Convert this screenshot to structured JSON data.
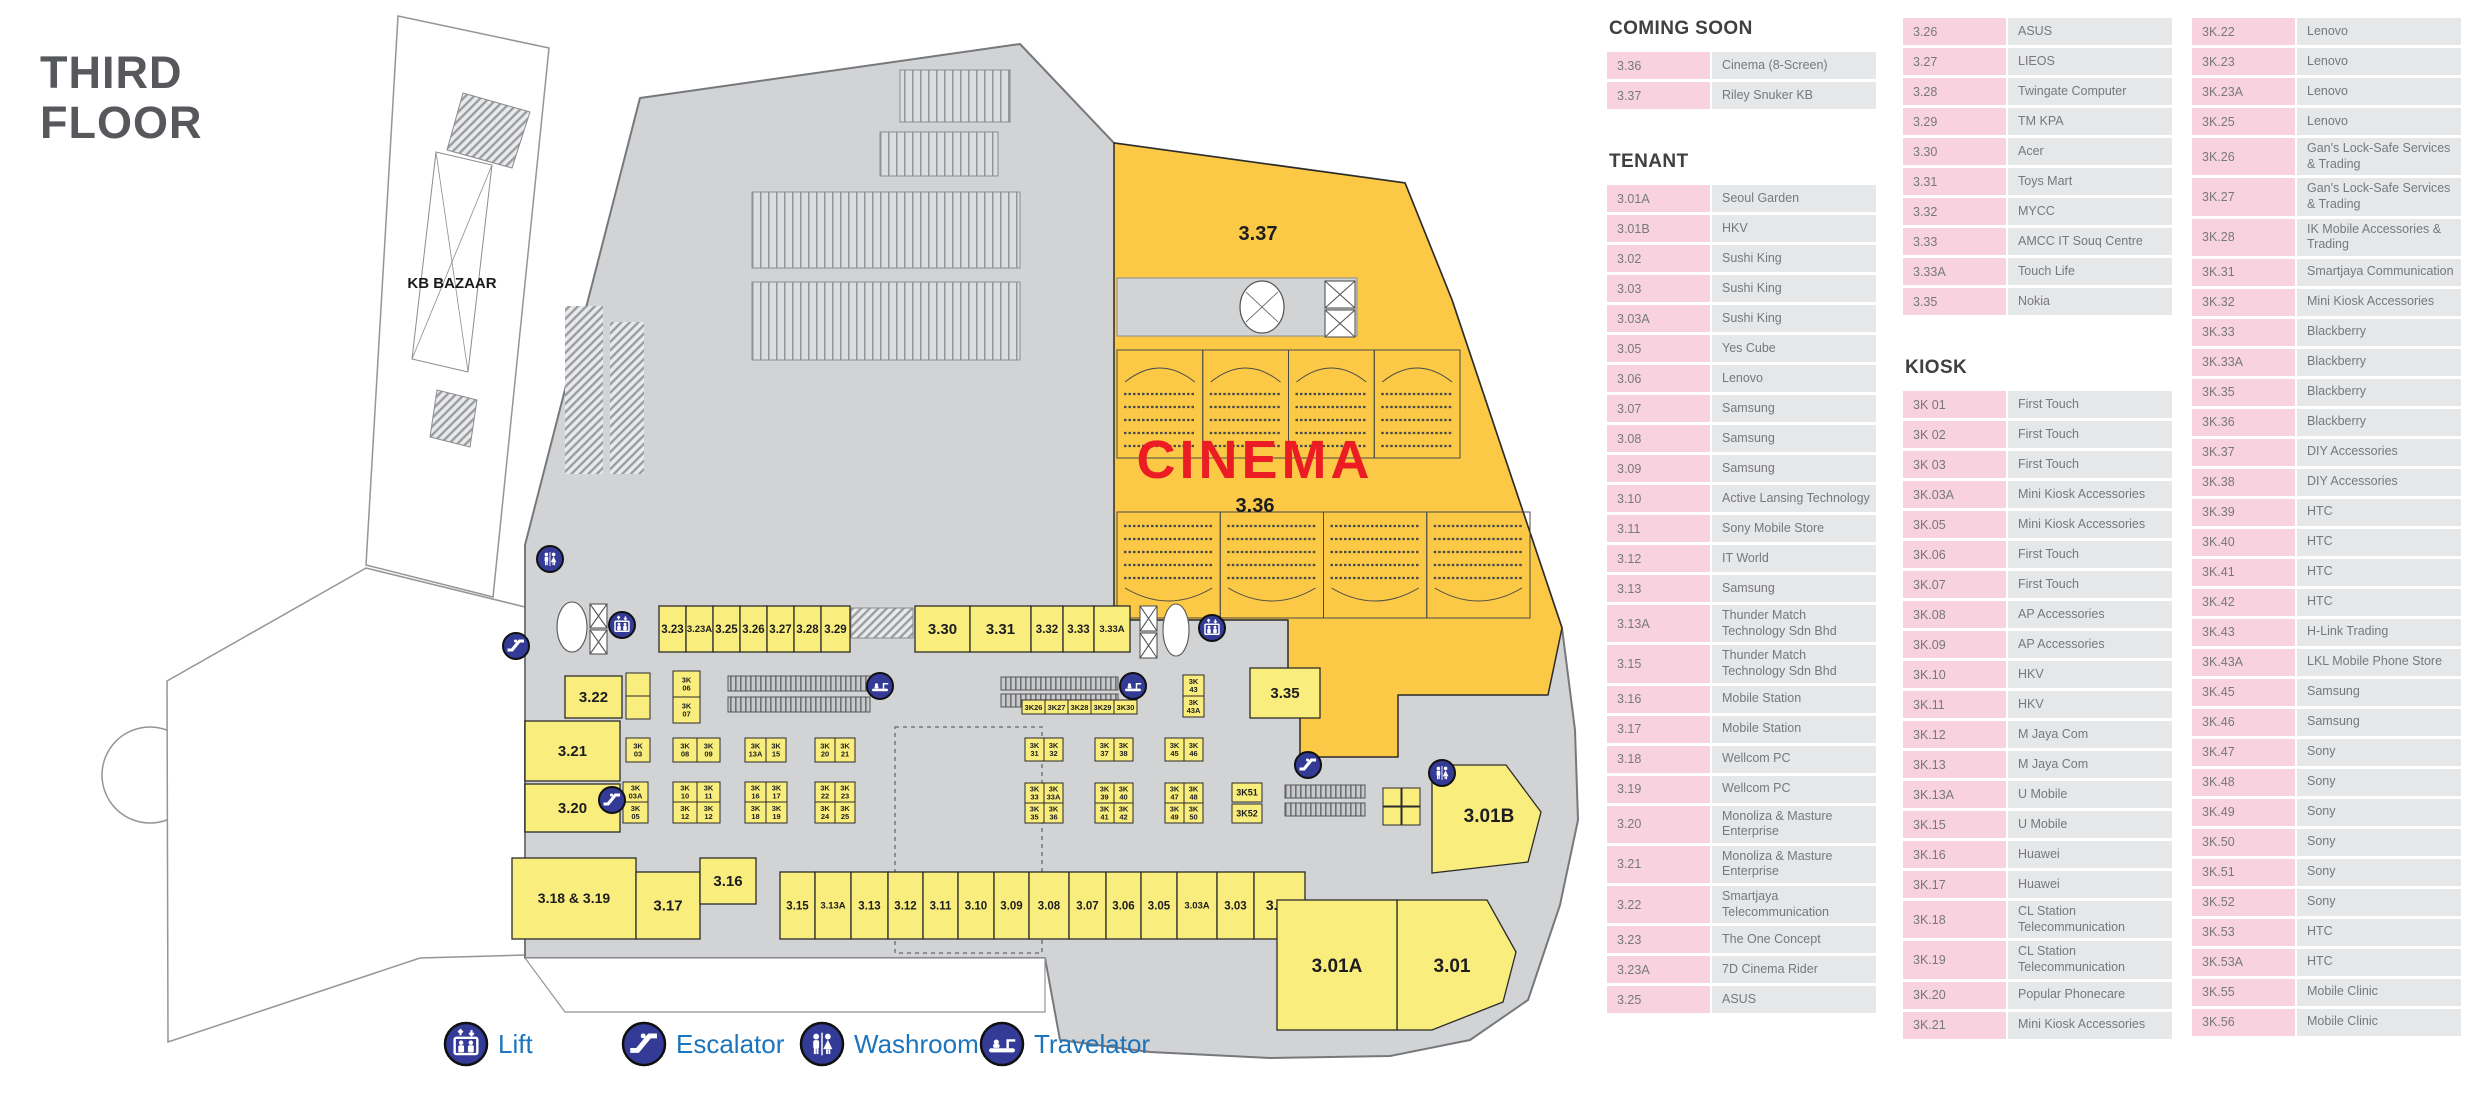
{
  "title": {
    "line1": "THIRD",
    "line2": "FLOOR"
  },
  "colors": {
    "plan_gray": "#d2d3d5",
    "unit_yellow": "#f9ee7d",
    "cinema_amber": "#fbc945",
    "cinema_red": "#ec1c24",
    "icon_blue": "#343b97",
    "legend_text_blue": "#1c75bc",
    "dir_pink": "#f8d3df",
    "dir_gray": "#e6e7e8",
    "title_gray": "#57585b"
  },
  "legend": [
    {
      "icon": "lift-icon",
      "type": "lift",
      "label": "Lift",
      "cx": 466
    },
    {
      "icon": "escalator-icon",
      "type": "escalator",
      "label": "Escalator",
      "cx": 644
    },
    {
      "icon": "washroom-icon",
      "type": "washroom",
      "label": "Washroom",
      "cx": 822
    },
    {
      "icon": "travelator-icon",
      "type": "travelator",
      "label": "Travelator",
      "cx": 1002
    }
  ],
  "plan": {
    "labels": [
      {
        "t": "KB BAZAAR",
        "x": 452,
        "y": 288,
        "fs": 15,
        "c": "#1a1a1a"
      },
      {
        "t": "3.37",
        "x": 1258,
        "y": 240,
        "fs": 20,
        "c": "#1d1d1f"
      },
      {
        "t": "CINEMA",
        "x": 1255,
        "y": 478,
        "fs": 54,
        "c": "#ec1c24",
        "ls": 4
      },
      {
        "t": "3.36",
        "x": 1255,
        "y": 512,
        "fs": 20,
        "c": "#1d1d1f"
      },
      {
        "t": "3.01B",
        "x": 1489,
        "y": 822,
        "fs": 19,
        "c": "#1d1d1f"
      },
      {
        "t": "3.01A",
        "x": 1337,
        "y": 972,
        "fs": 19,
        "c": "#1d1d1f"
      },
      {
        "t": "3.01",
        "x": 1452,
        "y": 972,
        "fs": 19,
        "c": "#1d1d1f"
      }
    ],
    "shops": [
      {
        "l": "3.23",
        "x": 659,
        "y": 606,
        "w": 27,
        "h": 46
      },
      {
        "l": "3.23A",
        "x": 686,
        "y": 606,
        "w": 27,
        "h": 46
      },
      {
        "l": "3.25",
        "x": 713,
        "y": 606,
        "w": 27,
        "h": 46
      },
      {
        "l": "3.26",
        "x": 740,
        "y": 606,
        "w": 27,
        "h": 46
      },
      {
        "l": "3.27",
        "x": 767,
        "y": 606,
        "w": 27,
        "h": 46
      },
      {
        "l": "3.28",
        "x": 794,
        "y": 606,
        "w": 27,
        "h": 46
      },
      {
        "l": "3.29",
        "x": 821,
        "y": 606,
        "w": 29,
        "h": 46
      },
      {
        "l": "3.30",
        "x": 915,
        "y": 606,
        "w": 55,
        "h": 46
      },
      {
        "l": "3.31",
        "x": 970,
        "y": 606,
        "w": 61,
        "h": 46
      },
      {
        "l": "3.32",
        "x": 1031,
        "y": 606,
        "w": 32,
        "h": 46
      },
      {
        "l": "3.33",
        "x": 1063,
        "y": 606,
        "w": 31,
        "h": 46
      },
      {
        "l": "3.33A",
        "x": 1094,
        "y": 606,
        "w": 36,
        "h": 46
      },
      {
        "l": "3.35",
        "x": 1250,
        "y": 668,
        "w": 70,
        "h": 50
      },
      {
        "l": "3.22",
        "x": 565,
        "y": 676,
        "w": 57,
        "h": 42
      },
      {
        "l": "3.21",
        "x": 525,
        "y": 721,
        "w": 95,
        "h": 60
      },
      {
        "l": "3.20",
        "x": 525,
        "y": 784,
        "w": 95,
        "h": 48
      },
      {
        "l": "3.18 & 3.19",
        "x": 512,
        "y": 858,
        "w": 124,
        "h": 81,
        "fs": 14
      },
      {
        "l": "3.17",
        "x": 636,
        "y": 872,
        "w": 64,
        "h": 67
      },
      {
        "l": "3.16",
        "x": 700,
        "y": 858,
        "w": 56,
        "h": 46
      },
      {
        "l": "3.15",
        "x": 780,
        "y": 872,
        "w": 35,
        "h": 67
      },
      {
        "l": "3.13A",
        "x": 815,
        "y": 872,
        "w": 36,
        "h": 67
      },
      {
        "l": "3.13",
        "x": 851,
        "y": 872,
        "w": 37,
        "h": 67
      },
      {
        "l": "3.12",
        "x": 888,
        "y": 872,
        "w": 35,
        "h": 67
      },
      {
        "l": "3.11",
        "x": 923,
        "y": 872,
        "w": 35,
        "h": 67
      },
      {
        "l": "3.10",
        "x": 958,
        "y": 872,
        "w": 36,
        "h": 67
      },
      {
        "l": "3.09",
        "x": 994,
        "y": 872,
        "w": 35,
        "h": 67
      },
      {
        "l": "3.08",
        "x": 1029,
        "y": 872,
        "w": 40,
        "h": 67
      },
      {
        "l": "3.07",
        "x": 1069,
        "y": 872,
        "w": 37,
        "h": 67
      },
      {
        "l": "3.06",
        "x": 1106,
        "y": 872,
        "w": 35,
        "h": 67
      },
      {
        "l": "3.05",
        "x": 1141,
        "y": 872,
        "w": 36,
        "h": 67
      },
      {
        "l": "3.03A",
        "x": 1177,
        "y": 872,
        "w": 40,
        "h": 67
      },
      {
        "l": "3.03",
        "x": 1217,
        "y": 872,
        "w": 37,
        "h": 67
      },
      {
        "l": "3.02",
        "x": 1254,
        "y": 872,
        "w": 51,
        "h": 67
      },
      {
        "l": "3.01A",
        "x": 1277,
        "y": 900,
        "w": 120,
        "h": 130,
        "fs": 0
      }
    ],
    "kiosks": [
      {
        "l": "",
        "x": 626,
        "y": 673,
        "w": 24,
        "h": 23
      },
      {
        "l": "",
        "x": 626,
        "y": 696,
        "w": 24,
        "h": 23
      },
      {
        "l": "3K 06",
        "x": 673,
        "y": 671,
        "w": 27,
        "h": 26
      },
      {
        "l": "3K 07",
        "x": 673,
        "y": 697,
        "w": 27,
        "h": 26
      },
      {
        "l": "3K 03",
        "x": 626,
        "y": 738,
        "w": 24,
        "h": 24
      },
      {
        "l": "3K 08",
        "x": 673,
        "y": 738,
        "w": 24,
        "h": 24
      },
      {
        "l": "3K 09",
        "x": 697,
        "y": 738,
        "w": 23,
        "h": 24
      },
      {
        "l": "3K 13A",
        "x": 745,
        "y": 738,
        "w": 21,
        "h": 24
      },
      {
        "l": "3K 15",
        "x": 766,
        "y": 738,
        "w": 20,
        "h": 24
      },
      {
        "l": "3K 20",
        "x": 815,
        "y": 738,
        "w": 20,
        "h": 24
      },
      {
        "l": "3K 21",
        "x": 835,
        "y": 738,
        "w": 20,
        "h": 24
      },
      {
        "l": "3K 03A",
        "x": 623,
        "y": 782,
        "w": 25,
        "h": 20
      },
      {
        "l": "3K 05",
        "x": 623,
        "y": 802,
        "w": 25,
        "h": 21
      },
      {
        "l": "3K 10",
        "x": 673,
        "y": 782,
        "w": 24,
        "h": 20
      },
      {
        "l": "3K 11",
        "x": 697,
        "y": 782,
        "w": 23,
        "h": 20
      },
      {
        "l": "3K 12",
        "x": 673,
        "y": 802,
        "w": 24,
        "h": 21
      },
      {
        "l": "3K 12",
        "x": 697,
        "y": 802,
        "w": 23,
        "h": 21
      },
      {
        "l": "3K 16",
        "x": 745,
        "y": 782,
        "w": 21,
        "h": 20
      },
      {
        "l": "3K 17",
        "x": 766,
        "y": 782,
        "w": 21,
        "h": 20
      },
      {
        "l": "3K 18",
        "x": 745,
        "y": 802,
        "w": 21,
        "h": 21
      },
      {
        "l": "3K 19",
        "x": 766,
        "y": 802,
        "w": 21,
        "h": 21
      },
      {
        "l": "3K 22",
        "x": 815,
        "y": 782,
        "w": 20,
        "h": 20
      },
      {
        "l": "3K 23",
        "x": 835,
        "y": 782,
        "w": 20,
        "h": 20
      },
      {
        "l": "3K 24",
        "x": 815,
        "y": 802,
        "w": 20,
        "h": 21
      },
      {
        "l": "3K 25",
        "x": 835,
        "y": 802,
        "w": 20,
        "h": 21
      },
      {
        "l": "3K26",
        "x": 1022,
        "y": 700,
        "w": 23,
        "h": 14
      },
      {
        "l": "3K27",
        "x": 1045,
        "y": 700,
        "w": 23,
        "h": 14
      },
      {
        "l": "3K28",
        "x": 1068,
        "y": 700,
        "w": 23,
        "h": 14
      },
      {
        "l": "3K29",
        "x": 1091,
        "y": 700,
        "w": 23,
        "h": 14
      },
      {
        "l": "3K30",
        "x": 1114,
        "y": 700,
        "w": 23,
        "h": 14
      },
      {
        "l": "3K 43",
        "x": 1183,
        "y": 675,
        "w": 21,
        "h": 21
      },
      {
        "l": "3K 43A",
        "x": 1183,
        "y": 696,
        "w": 21,
        "h": 21
      },
      {
        "l": "3K 31",
        "x": 1025,
        "y": 738,
        "w": 19,
        "h": 23
      },
      {
        "l": "3K 32",
        "x": 1044,
        "y": 738,
        "w": 19,
        "h": 23
      },
      {
        "l": "3K 37",
        "x": 1095,
        "y": 738,
        "w": 19,
        "h": 23
      },
      {
        "l": "3K 38",
        "x": 1114,
        "y": 738,
        "w": 19,
        "h": 23
      },
      {
        "l": "3K 45",
        "x": 1165,
        "y": 738,
        "w": 19,
        "h": 23
      },
      {
        "l": "3K 46",
        "x": 1184,
        "y": 738,
        "w": 19,
        "h": 23
      },
      {
        "l": "3K 33",
        "x": 1025,
        "y": 783,
        "w": 19,
        "h": 20
      },
      {
        "l": "3K 33A",
        "x": 1044,
        "y": 783,
        "w": 19,
        "h": 20
      },
      {
        "l": "3K 35",
        "x": 1025,
        "y": 803,
        "w": 19,
        "h": 20
      },
      {
        "l": "3K 36",
        "x": 1044,
        "y": 803,
        "w": 19,
        "h": 20
      },
      {
        "l": "3K 39",
        "x": 1095,
        "y": 783,
        "w": 19,
        "h": 20
      },
      {
        "l": "3K 40",
        "x": 1114,
        "y": 783,
        "w": 19,
        "h": 20
      },
      {
        "l": "3K 41",
        "x": 1095,
        "y": 803,
        "w": 19,
        "h": 20
      },
      {
        "l": "3K 42",
        "x": 1114,
        "y": 803,
        "w": 19,
        "h": 20
      },
      {
        "l": "3K 47",
        "x": 1165,
        "y": 783,
        "w": 19,
        "h": 20
      },
      {
        "l": "3K 48",
        "x": 1184,
        "y": 783,
        "w": 19,
        "h": 20
      },
      {
        "l": "3K 49",
        "x": 1165,
        "y": 803,
        "w": 19,
        "h": 20
      },
      {
        "l": "3K 50",
        "x": 1184,
        "y": 803,
        "w": 19,
        "h": 20
      },
      {
        "l": "3K51",
        "x": 1232,
        "y": 783,
        "w": 30,
        "h": 19
      },
      {
        "l": "3K52",
        "x": 1232,
        "y": 804,
        "w": 30,
        "h": 19
      },
      {
        "l": "",
        "x": 1383,
        "y": 788,
        "w": 18,
        "h": 18
      },
      {
        "l": "",
        "x": 1402,
        "y": 788,
        "w": 18,
        "h": 18
      },
      {
        "l": "",
        "x": 1383,
        "y": 807,
        "w": 18,
        "h": 18
      },
      {
        "l": "",
        "x": 1402,
        "y": 807,
        "w": 18,
        "h": 18
      }
    ],
    "icons": [
      {
        "type": "washroom",
        "cx": 550,
        "cy": 559
      },
      {
        "type": "lift",
        "cx": 622,
        "cy": 625
      },
      {
        "type": "escalator",
        "cx": 516,
        "cy": 646
      },
      {
        "type": "escalator",
        "cx": 612,
        "cy": 800
      },
      {
        "type": "travelator",
        "cx": 880,
        "cy": 686
      },
      {
        "type": "travelator",
        "cx": 1133,
        "cy": 686
      },
      {
        "type": "lift",
        "cx": 1212,
        "cy": 628
      },
      {
        "type": "escalator",
        "cx": 1308,
        "cy": 765
      },
      {
        "type": "washroom",
        "cx": 1442,
        "cy": 773
      }
    ]
  },
  "directory": {
    "columns": [
      [
        {
          "header": "COMING SOON"
        },
        {
          "id": "3.36",
          "name": "Cinema (8-Screen)"
        },
        {
          "id": "3.37",
          "name": "Riley Snuker KB"
        },
        {
          "header": "TENANT",
          "gap": 42
        },
        {
          "id": "3.01A",
          "name": "Seoul Garden"
        },
        {
          "id": "3.01B",
          "name": "HKV"
        },
        {
          "id": "3.02",
          "name": "Sushi King"
        },
        {
          "id": "3.03",
          "name": "Sushi King"
        },
        {
          "id": "3.03A",
          "name": "Sushi King"
        },
        {
          "id": "3.05",
          "name": "Yes Cube"
        },
        {
          "id": "3.06",
          "name": "Lenovo"
        },
        {
          "id": "3.07",
          "name": "Samsung"
        },
        {
          "id": "3.08",
          "name": "Samsung"
        },
        {
          "id": "3.09",
          "name": "Samsung"
        },
        {
          "id": "3.10",
          "name": "Active Lansing Technology"
        },
        {
          "id": "3.11",
          "name": "Sony Mobile Store"
        },
        {
          "id": "3.12",
          "name": "IT World"
        },
        {
          "id": "3.13",
          "name": "Samsung"
        },
        {
          "id": "3.13A",
          "name": "Thunder Match Technology Sdn Bhd"
        },
        {
          "id": "3.15",
          "name": "Thunder Match Technology Sdn Bhd"
        },
        {
          "id": "3.16",
          "name": "Mobile Station"
        },
        {
          "id": "3.17",
          "name": "Mobile Station"
        },
        {
          "id": "3.18",
          "name": "Wellcom PC"
        },
        {
          "id": "3.19",
          "name": "Wellcom PC"
        },
        {
          "id": "3.20",
          "name": "Monoliza & Masture Enterprise"
        },
        {
          "id": "3.21",
          "name": "Monoliza & Masture Enterprise"
        },
        {
          "id": "3.22",
          "name": "Smartjaya Telecommunication"
        },
        {
          "id": "3.23",
          "name": "The One Concept"
        },
        {
          "id": "3.23A",
          "name": "7D Cinema Rider"
        },
        {
          "id": "3.25",
          "name": "ASUS"
        }
      ],
      [
        {
          "id": "3.26",
          "name": "ASUS"
        },
        {
          "id": "3.27",
          "name": "LIEOS"
        },
        {
          "id": "3.28",
          "name": "Twingate Computer"
        },
        {
          "id": "3.29",
          "name": "TM KPA"
        },
        {
          "id": "3.30",
          "name": "Acer"
        },
        {
          "id": "3.31",
          "name": "Toys Mart"
        },
        {
          "id": "3.32",
          "name": "MYCC"
        },
        {
          "id": "3.33",
          "name": "AMCC IT Souq Centre"
        },
        {
          "id": "3.33A",
          "name": "Touch Life"
        },
        {
          "id": "3.35",
          "name": "Nokia"
        },
        {
          "header": "KIOSK",
          "gap": 42
        },
        {
          "id": "3K 01",
          "name": "First Touch"
        },
        {
          "id": "3K 02",
          "name": "First Touch"
        },
        {
          "id": "3K 03",
          "name": "First Touch"
        },
        {
          "id": "3K.03A",
          "name": "Mini Kiosk Accessories"
        },
        {
          "id": "3K.05",
          "name": "Mini Kiosk Accessories"
        },
        {
          "id": "3K.06",
          "name": "First Touch"
        },
        {
          "id": "3K.07",
          "name": "First Touch"
        },
        {
          "id": "3K.08",
          "name": "AP Accessories"
        },
        {
          "id": "3K.09",
          "name": "AP Accessories"
        },
        {
          "id": "3K.10",
          "name": "HKV"
        },
        {
          "id": "3K.11",
          "name": "HKV"
        },
        {
          "id": "3K.12",
          "name": "M Jaya Com"
        },
        {
          "id": "3K.13",
          "name": "M Jaya Com"
        },
        {
          "id": "3K.13A",
          "name": "U Mobile"
        },
        {
          "id": "3K.15",
          "name": "U Mobile"
        },
        {
          "id": "3K.16",
          "name": "Huawei"
        },
        {
          "id": "3K.17",
          "name": "Huawei"
        },
        {
          "id": "3K.18",
          "name": "CL Station Telecommunication"
        },
        {
          "id": "3K.19",
          "name": "CL Station Telecommunication"
        },
        {
          "id": "3K.20",
          "name": "Popular Phonecare"
        },
        {
          "id": "3K.21",
          "name": "Mini Kiosk Accessories"
        }
      ],
      [
        {
          "id": "3K.22",
          "name": "Lenovo"
        },
        {
          "id": "3K.23",
          "name": "Lenovo"
        },
        {
          "id": "3K.23A",
          "name": "Lenovo"
        },
        {
          "id": "3K.25",
          "name": "Lenovo"
        },
        {
          "id": "3K.26",
          "name": "Gan's Lock-Safe Services & Trading"
        },
        {
          "id": "3K.27",
          "name": "Gan's Lock-Safe Services & Trading"
        },
        {
          "id": "3K.28",
          "name": "IK Mobile Accessories & Trading"
        },
        {
          "id": "3K.31",
          "name": "Smartjaya Communication"
        },
        {
          "id": "3K.32",
          "name": "Mini Kiosk Accessories"
        },
        {
          "id": "3K.33",
          "name": "Blackberry"
        },
        {
          "id": "3K.33A",
          "name": "Blackberry"
        },
        {
          "id": "3K.35",
          "name": "Blackberry"
        },
        {
          "id": "3K.36",
          "name": "Blackberry"
        },
        {
          "id": "3K.37",
          "name": "DIY Accessories"
        },
        {
          "id": "3K.38",
          "name": "DIY Accessories"
        },
        {
          "id": "3K.39",
          "name": "HTC"
        },
        {
          "id": "3K.40",
          "name": "HTC"
        },
        {
          "id": "3K.41",
          "name": "HTC"
        },
        {
          "id": "3K.42",
          "name": "HTC"
        },
        {
          "id": "3K.43",
          "name": "H-Link Trading"
        },
        {
          "id": "3K.43A",
          "name": "LKL Mobile Phone Store"
        },
        {
          "id": "3K.45",
          "name": "Samsung"
        },
        {
          "id": "3K.46",
          "name": "Samsung"
        },
        {
          "id": "3K.47",
          "name": "Sony"
        },
        {
          "id": "3K.48",
          "name": "Sony"
        },
        {
          "id": "3K.49",
          "name": "Sony"
        },
        {
          "id": "3K.50",
          "name": "Sony"
        },
        {
          "id": "3K.51",
          "name": "Sony"
        },
        {
          "id": "3K.52",
          "name": "Sony"
        },
        {
          "id": "3K.53",
          "name": "HTC"
        },
        {
          "id": "3K.53A",
          "name": "HTC"
        },
        {
          "id": "3K.55",
          "name": "Mobile Clinic"
        },
        {
          "id": "3K.56",
          "name": "Mobile Clinic"
        }
      ]
    ]
  }
}
